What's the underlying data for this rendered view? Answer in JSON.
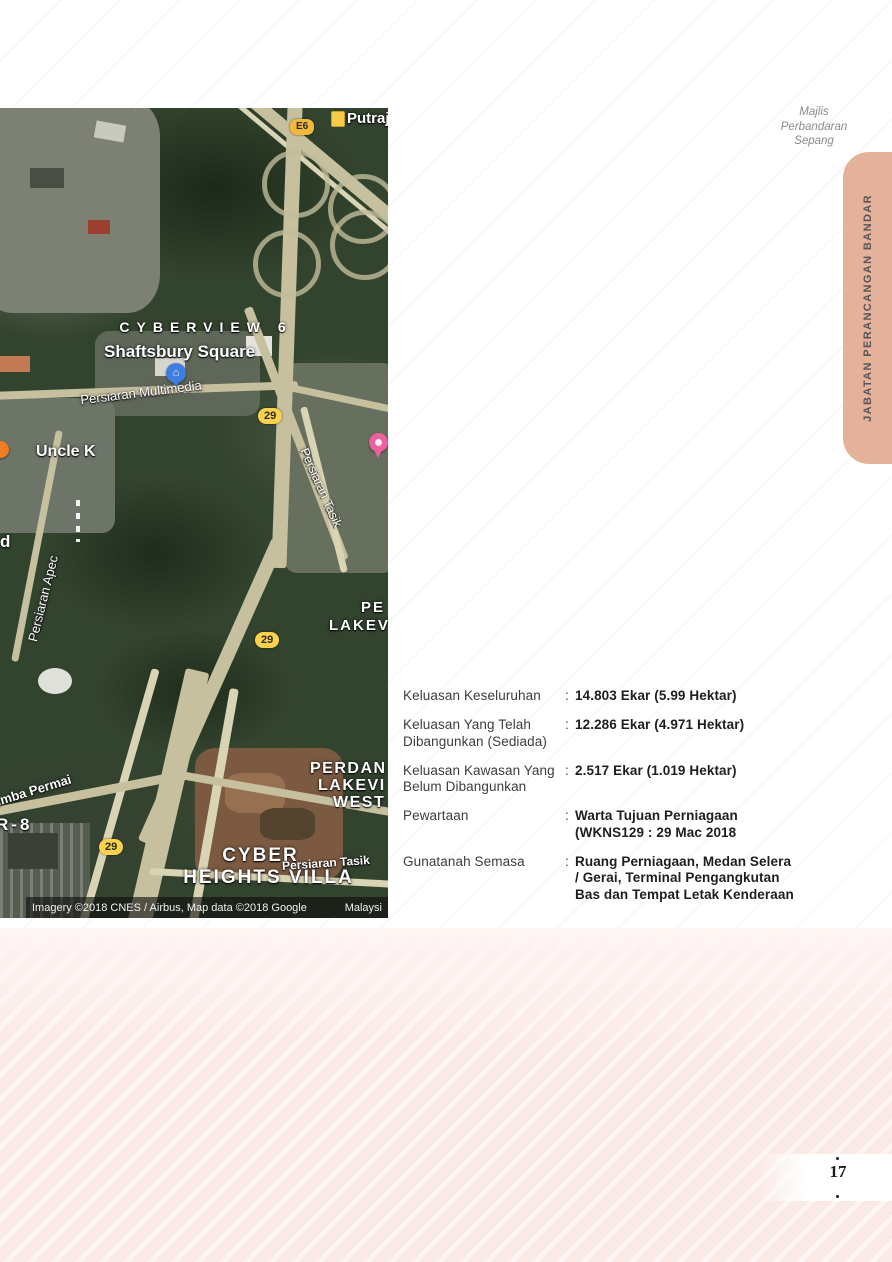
{
  "header": {
    "org_line1": "Majlis",
    "org_line2": "Perbandaran",
    "org_line3": "Sepang"
  },
  "side_tab": {
    "label": "JABATAN PERANCANGAN BANDAR",
    "color": "#e4b19b"
  },
  "details": {
    "colon": ":",
    "rows": [
      {
        "label": "Keluasan Keseluruhan",
        "value": "14.803 Ekar (5.99 Hektar)"
      },
      {
        "label": "Keluasan Yang Telah Dibangunkan (Sediada)",
        "value": "12.286 Ekar (4.971 Hektar)"
      },
      {
        "label": "Keluasan Kawasan Yang Belum Dibangunkan",
        "value": "2.517 Ekar (1.019 Hektar)"
      },
      {
        "label": "Pewartaan",
        "value": "Warta Tujuan Perniagaan (WKNS129 : 29 Mac 2018"
      },
      {
        "label": "Gunatanah Semasa",
        "value": "Ruang Perniagaan, Medan Selera / Gerai, Terminal Pengangkutan Bas dan Tempat Letak Kenderaan"
      }
    ]
  },
  "map": {
    "labels": {
      "putrajaya": "Putraja",
      "shield_e6": "E6",
      "shield_29": "29",
      "cyberview": "CYBERVIEW 6",
      "shaftsbury": "Shaftsbury Square",
      "multimedia": "Persiaran Multimedia",
      "tasik_upper": "Persiaran Tasik",
      "uncle_k": "Uncle K",
      "partial_d": "d",
      "apec": "Persiaran Apec",
      "pe_partial": "PE",
      "lakev_partial": "LAKEV",
      "perdan_partial": "PERDAN",
      "lakevi_partial": "LAKEVI",
      "west_partial": "WEST",
      "rimba": "Rimba Permai",
      "r8": "R-8",
      "cyber": "CYBER",
      "heights_villa": "HEIGHTS VILLA",
      "tasik_lower": "Persiaran Tasik",
      "attribution": "Imagery ©2018 CNES / Airbus, Map data ©2018 Google",
      "country_partial": "Malaysi"
    },
    "colors": {
      "route_shield": "#fcd24c",
      "marker_blue": "#3f7de0",
      "marker_pink": "#ee5f9e",
      "marker_orange": "#ef7d21"
    }
  },
  "footer": {
    "page_number": "17",
    "pink_band_color": "#fbe9e6"
  }
}
